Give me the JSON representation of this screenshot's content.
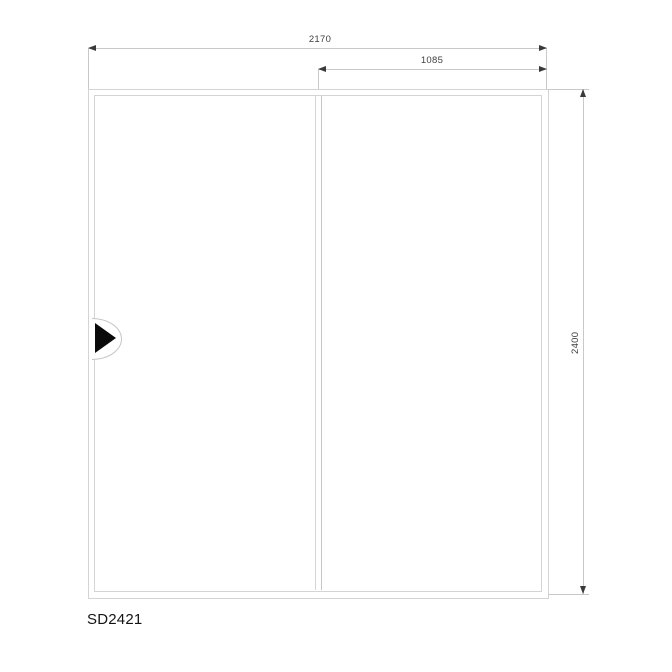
{
  "labels": {
    "model": "SD2421"
  },
  "dimensions": {
    "overall_width": "2170",
    "panel_width": "1085",
    "overall_height": "2400"
  },
  "icons": {
    "slide_direction": "right-pointing-triangle"
  },
  "colors": {
    "background": "#ffffff",
    "frame_line": "#d4d4d4",
    "dimension_line": "#c9c9c9",
    "arrowhead": "#3a3a3a",
    "dimension_text": "#3f3f3f",
    "model_text": "#141414",
    "handle_arrow": "#0a0a0a"
  }
}
